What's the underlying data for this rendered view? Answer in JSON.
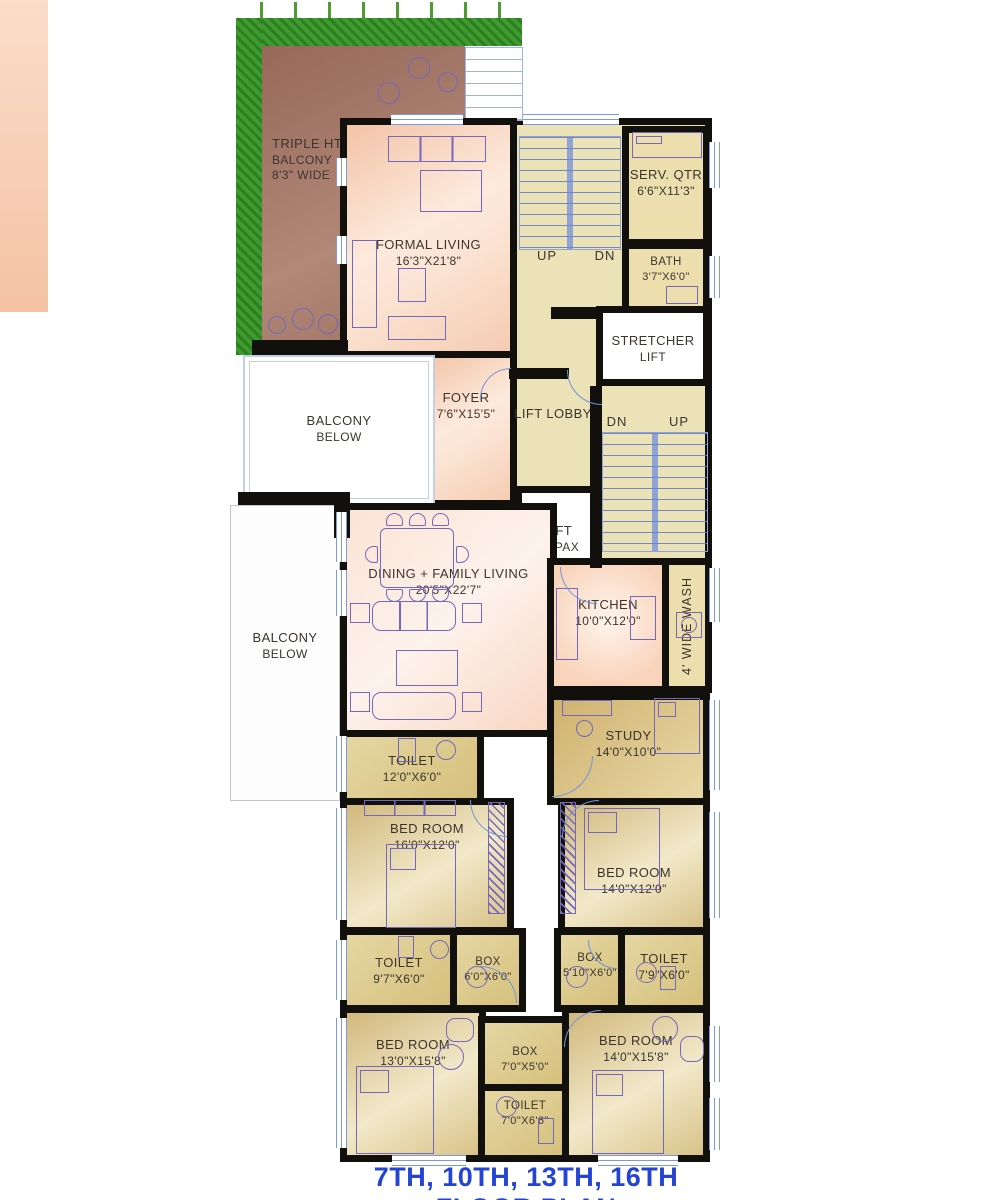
{
  "title": {
    "text": "7TH, 10TH, 13TH, 16TH  FLOOR PLAN",
    "color": "#2444d4"
  },
  "palette": {
    "wall": "#12100d",
    "living_pink": "#f6cfb8",
    "service_beige": "#ece2b8",
    "bedroom_tan": "#d8c288",
    "balcony_brown": "#9b7060",
    "planter_green": "#3f9a2f",
    "furniture_purple": "#7568bb",
    "window_blue": "#7e99cf"
  },
  "rooms": [
    {
      "id": "triple-ht-balcony",
      "lines": [
        "TRIPLE HT.",
        "BALCONY",
        "8'3\" WIDE"
      ]
    },
    {
      "id": "formal-living",
      "lines": [
        "FORMAL LIVING",
        "16'3\"X21'8\""
      ]
    },
    {
      "id": "serv-qtr",
      "lines": [
        "SERV. QTR",
        "6'6\"X11'3\""
      ]
    },
    {
      "id": "bath",
      "lines": [
        "BATH",
        "3'7\"X6'0\""
      ]
    },
    {
      "id": "stretcher-lift",
      "lines": [
        "STRETCHER",
        "LIFT"
      ]
    },
    {
      "id": "foyer",
      "lines": [
        "FOYER",
        "7'6\"X15'5\""
      ]
    },
    {
      "id": "lift-lobby",
      "lines": [
        "LIFT LOBBY"
      ]
    },
    {
      "id": "lift",
      "lines": [
        "LIFT",
        "10 PAX"
      ]
    },
    {
      "id": "balcony-below-1",
      "lines": [
        "BALCONY",
        "BELOW"
      ]
    },
    {
      "id": "balcony-below-2",
      "lines": [
        "BALCONY",
        "BELOW"
      ]
    },
    {
      "id": "dining-family-living",
      "lines": [
        "DINING + FAMILY LIVING",
        "20'5\"X22'7\""
      ]
    },
    {
      "id": "kitchen",
      "lines": [
        "KITCHEN",
        "10'0\"X12'0\""
      ]
    },
    {
      "id": "wash",
      "lines": [
        "4' WIDE WASH"
      ]
    },
    {
      "id": "study",
      "lines": [
        "STUDY",
        "14'0\"X10'0\""
      ]
    },
    {
      "id": "toilet-1",
      "lines": [
        "TOILET",
        "12'0\"X6'0\""
      ]
    },
    {
      "id": "bedroom-1",
      "lines": [
        "BED ROOM",
        "16'0\"X12'0\""
      ]
    },
    {
      "id": "bedroom-2",
      "lines": [
        "BED ROOM",
        "14'0\"X12'0\""
      ]
    },
    {
      "id": "toilet-2",
      "lines": [
        "TOILET",
        "9'7\"X6'0\""
      ]
    },
    {
      "id": "box-1",
      "lines": [
        "BOX",
        "6'0\"X6'0\""
      ]
    },
    {
      "id": "box-2",
      "lines": [
        "BOX",
        "5'10\"X6'0\""
      ]
    },
    {
      "id": "toilet-3",
      "lines": [
        "TOILET",
        "7'9\"X6'0\""
      ]
    },
    {
      "id": "bedroom-3",
      "lines": [
        "BED ROOM",
        "13'0\"X15'8\""
      ]
    },
    {
      "id": "box-3",
      "lines": [
        "BOX",
        "7'0\"X5'0\""
      ]
    },
    {
      "id": "toilet-4",
      "lines": [
        "TOILET",
        "7'0\"X6'6\""
      ]
    },
    {
      "id": "bedroom-4",
      "lines": [
        "BED ROOM",
        "14'0\"X15'8\""
      ]
    }
  ],
  "stairs": [
    {
      "id": "stair-upper",
      "labels": [
        "UP",
        "DN"
      ]
    },
    {
      "id": "stair-lower",
      "labels": [
        "DN",
        "UP"
      ]
    }
  ]
}
